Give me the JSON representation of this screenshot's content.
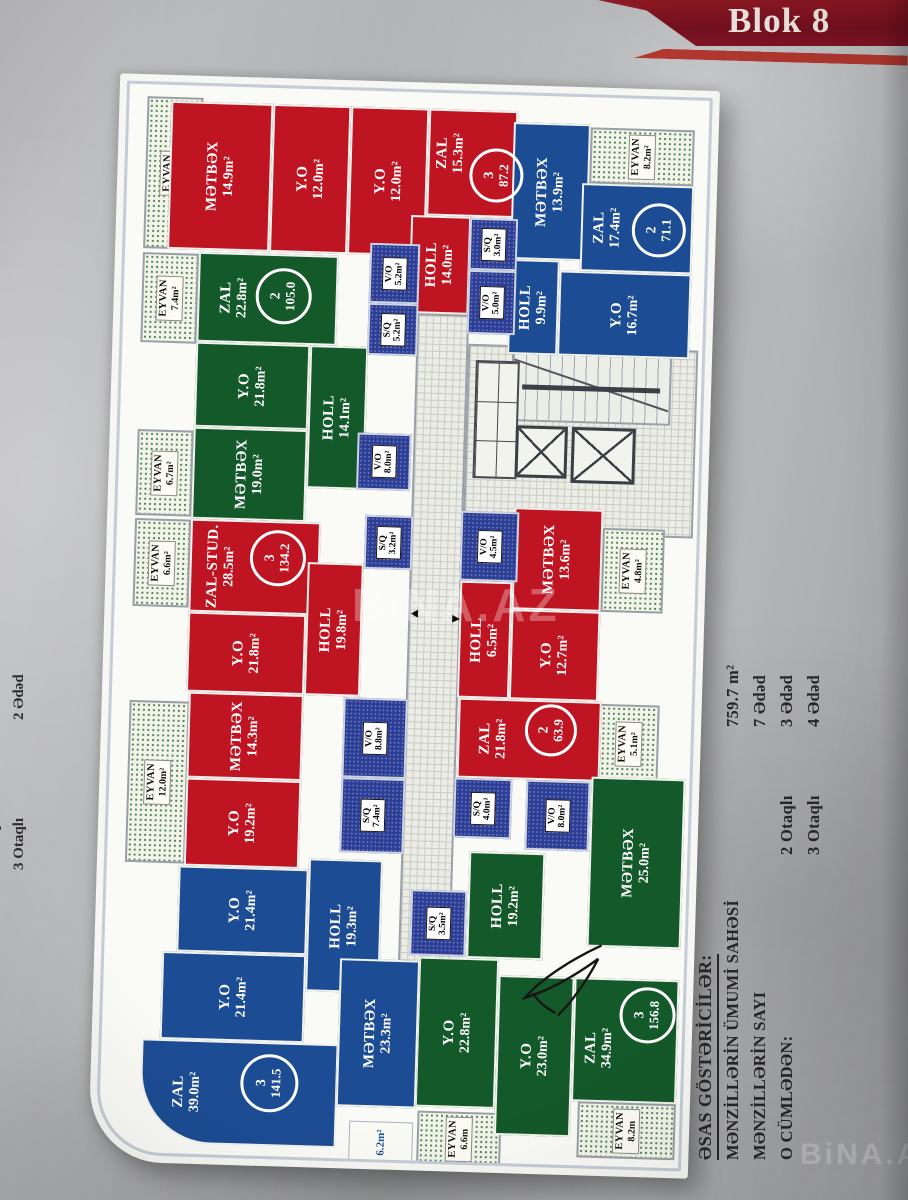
{
  "banner": {
    "title": "Blok 8"
  },
  "watermark": "BiNA.AZ",
  "legend_right": {
    "title": "ƏSAS GÖSTƏRİCİLƏR:",
    "rows": [
      {
        "label": "MƏNZİLLƏRİN ÜMUMİ SAHƏSİ",
        "mid": "",
        "value": "759.7 m²"
      },
      {
        "label": "MƏNZİLLƏRİN SAYI",
        "mid": "",
        "value": "7 Ədəd"
      },
      {
        "label": "O CÜMLƏDƏN:",
        "mid": "2 Otaqlı",
        "value": "3 Ədəd"
      },
      {
        "label": "",
        "mid": "3 Otaqlı",
        "value": "4 Ədəd"
      }
    ]
  },
  "legend_left": {
    "rows": [
      {
        "label": "2 Otaqlı",
        "value": "2 Ədəd"
      },
      {
        "label": "3 Otaqlı",
        "value": "2 Ədəd"
      }
    ]
  },
  "plan": {
    "rooms": [
      {
        "n": "EYVAN",
        "a": "10.8m²",
        "t": "eyvan",
        "x": 18,
        "y": 12,
        "w": 56,
        "h": 152
      },
      {
        "n": "EYVAN",
        "a": "7.4m²",
        "t": "eyvan",
        "x": 18,
        "y": 168,
        "w": 56,
        "h": 90
      },
      {
        "n": "EYVAN",
        "a": "6.7m²",
        "t": "eyvan",
        "x": 18,
        "y": 345,
        "w": 56,
        "h": 86
      },
      {
        "n": "EYVAN",
        "a": "6.6m²",
        "t": "eyvan",
        "x": 18,
        "y": 434,
        "w": 56,
        "h": 88
      },
      {
        "n": "EYVAN",
        "a": "12.0m²",
        "t": "eyvan",
        "x": 18,
        "y": 616,
        "w": 60,
        "h": 162
      },
      {
        "n": "EYVAN",
        "a": "8.2m²",
        "t": "eyvan",
        "x": 462,
        "y": 30,
        "w": 104,
        "h": 56
      },
      {
        "n": "EYVAN",
        "a": "4.8m²",
        "t": "eyvan",
        "x": 486,
        "y": 430,
        "w": 62,
        "h": 84
      },
      {
        "n": "EYVAN",
        "a": "5.1m²",
        "t": "eyvan",
        "x": 488,
        "y": 606,
        "w": 60,
        "h": 78
      },
      {
        "n": "EYVAN",
        "a": "6.6m",
        "t": "eyvan",
        "x": 318,
        "y": 1018,
        "w": 84,
        "h": 54
      },
      {
        "n": "EYVAN",
        "a": "8.2m",
        "t": "eyvan",
        "x": 478,
        "y": 1004,
        "w": 98,
        "h": 56
      },
      {
        "n": "",
        "a": "6.2m²",
        "t": "strip",
        "x": 250,
        "y": 1030,
        "w": 64,
        "h": 42
      },
      {
        "n": "MƏTBƏX",
        "a": "14.9m²",
        "t": "red",
        "x": 42,
        "y": 16,
        "w": 102,
        "h": 148
      },
      {
        "n": "Y.O",
        "a": "12.0m²",
        "t": "red",
        "x": 144,
        "y": 16,
        "w": 78,
        "h": 148
      },
      {
        "n": "Y.O",
        "a": "12.0m²",
        "t": "red",
        "x": 222,
        "y": 16,
        "w": 78,
        "h": 148
      },
      {
        "n": "ZAL",
        "a": "15.3m²",
        "t": "red",
        "x": 300,
        "y": 16,
        "w": 89,
        "h": 107,
        "dx": -22,
        "dy": -10
      },
      {
        "n": "HOLL",
        "a": "14.0m²",
        "t": "red",
        "x": 285,
        "y": 123,
        "w": 60,
        "h": 98
      },
      {
        "n": "MƏTBƏX",
        "a": "13.9m²",
        "t": "blue",
        "x": 385,
        "y": 27,
        "w": 77,
        "h": 137
      },
      {
        "n": "ZAL",
        "a": "17.4m²",
        "t": "blue",
        "x": 455,
        "y": 86,
        "w": 112,
        "h": 88,
        "dx": -30
      },
      {
        "n": "Y.O",
        "a": "16.7m²",
        "t": "blue",
        "x": 435,
        "y": 174,
        "w": 132,
        "h": 85
      },
      {
        "n": "HOLL",
        "a": "9.9m²",
        "t": "blue",
        "x": 385,
        "y": 164,
        "w": 50,
        "h": 95
      },
      {
        "n": "ZAL",
        "a": "22.8m²",
        "t": "green",
        "x": 74,
        "y": 166,
        "w": 140,
        "h": 90,
        "dx": -34
      },
      {
        "n": "Y.O",
        "a": "21.8m²",
        "t": "green",
        "x": 74,
        "y": 256,
        "w": 114,
        "h": 85
      },
      {
        "n": "MƏTBƏX",
        "a": "19.0m²",
        "t": "green",
        "x": 74,
        "y": 341,
        "w": 114,
        "h": 92
      },
      {
        "n": "HOLL",
        "a": "14.1m²",
        "t": "green",
        "x": 188,
        "y": 256,
        "w": 58,
        "h": 143
      },
      {
        "n": "ZAL-STUD.",
        "a": "28.5m²",
        "t": "red",
        "x": 74,
        "y": 433,
        "w": 130,
        "h": 93,
        "dx": -34
      },
      {
        "n": "Y.O",
        "a": "21.8m²",
        "t": "red",
        "x": 74,
        "y": 526,
        "w": 118,
        "h": 80
      },
      {
        "n": "MƏTBƏX",
        "a": "14.3m²",
        "t": "red",
        "x": 77,
        "y": 606,
        "w": 115,
        "h": 86
      },
      {
        "n": "Y.O",
        "a": "19.2m²",
        "t": "red",
        "x": 77,
        "y": 692,
        "w": 115,
        "h": 88
      },
      {
        "n": "HOLL",
        "a": "19.8m²",
        "t": "red",
        "x": 192,
        "y": 473,
        "w": 56,
        "h": 133
      },
      {
        "n": "MƏTBƏX",
        "a": "13.6m²",
        "t": "red",
        "x": 397,
        "y": 412,
        "w": 89,
        "h": 102
      },
      {
        "n": "HOLL",
        "a": "6.5m²",
        "t": "red",
        "x": 345,
        "y": 487,
        "w": 52,
        "h": 117
      },
      {
        "n": "Y.O",
        "a": "12.7m²",
        "t": "red",
        "x": 397,
        "y": 514,
        "w": 89,
        "h": 90
      },
      {
        "n": "ZAL",
        "a": "21.8m²",
        "t": "red",
        "x": 347,
        "y": 604,
        "w": 143,
        "h": 80,
        "dx": -36
      },
      {
        "n": "MƏTBƏX",
        "a": "25.0m²",
        "t": "green",
        "x": 482,
        "y": 679,
        "w": 94,
        "h": 170
      },
      {
        "n": "HOLL",
        "a": "19.2m²",
        "t": "green",
        "x": 362,
        "y": 757,
        "w": 76,
        "h": 107
      },
      {
        "n": "Y.O",
        "a": "22.8m²",
        "t": "green",
        "x": 315,
        "y": 864,
        "w": 80,
        "h": 150
      },
      {
        "n": "Y.O",
        "a": "23.0m²",
        "t": "green",
        "x": 395,
        "y": 880,
        "w": 76,
        "h": 160
      },
      {
        "n": "ZAL",
        "a": "34.9m²",
        "t": "green",
        "x": 471,
        "y": 880,
        "w": 105,
        "h": 124,
        "dx": -26,
        "dy": 8
      },
      {
        "n": "HOLL",
        "a": "19.3m²",
        "t": "blue",
        "x": 202,
        "y": 769,
        "w": 74,
        "h": 133
      },
      {
        "n": "Y.O",
        "a": "21.4m²",
        "t": "blue",
        "x": 72,
        "y": 780,
        "w": 130,
        "h": 86
      },
      {
        "n": "Y.O",
        "a": "21.4m²",
        "t": "blue",
        "x": 58,
        "y": 866,
        "w": 144,
        "h": 88
      },
      {
        "n": "ZAL",
        "a": "39.0m²",
        "t": "blue",
        "x": 40,
        "y": 954,
        "w": 197,
        "h": 104,
        "round": true,
        "dx": -52
      },
      {
        "n": "MƏTBƏX",
        "a": "23.3m²",
        "t": "blue",
        "x": 236,
        "y": 868,
        "w": 80,
        "h": 148
      },
      {
        "n": "S/Q",
        "a": "3.0m²",
        "t": "wet",
        "x": 344,
        "y": 124,
        "w": 48,
        "h": 52
      },
      {
        "n": "V/O",
        "a": "5.0m²",
        "t": "wet",
        "x": 344,
        "y": 176,
        "w": 48,
        "h": 64
      },
      {
        "n": "V/O",
        "a": "5.2m²",
        "t": "wet",
        "x": 245,
        "y": 152,
        "w": 50,
        "h": 60
      },
      {
        "n": "S/Q",
        "a": "5.2m²",
        "t": "wet",
        "x": 245,
        "y": 212,
        "w": 50,
        "h": 52
      },
      {
        "n": "V/O",
        "a": "8.0m²",
        "t": "wet",
        "x": 238,
        "y": 342,
        "w": 54,
        "h": 57
      },
      {
        "n": "S/Q",
        "a": "3.2m²",
        "t": "wet",
        "x": 248,
        "y": 424,
        "w": 48,
        "h": 54
      },
      {
        "n": "V/O",
        "a": "4.5m²",
        "t": "wet",
        "x": 344,
        "y": 417,
        "w": 58,
        "h": 70
      },
      {
        "n": "V/O",
        "a": "8.8m²",
        "t": "wet",
        "x": 232,
        "y": 607,
        "w": 64,
        "h": 80
      },
      {
        "n": "S/Q",
        "a": "7.4m²",
        "t": "wet",
        "x": 232,
        "y": 687,
        "w": 64,
        "h": 75
      },
      {
        "n": "S/Q",
        "a": "4.0m²",
        "t": "wet",
        "x": 345,
        "y": 684,
        "w": 58,
        "h": 60
      },
      {
        "n": "V/O",
        "a": "8.0m²",
        "t": "wet",
        "x": 417,
        "y": 684,
        "w": 64,
        "h": 70
      },
      {
        "n": "S/Q",
        "a": "3.5m²",
        "t": "wet",
        "x": 305,
        "y": 797,
        "w": 56,
        "h": 66
      }
    ],
    "badges": [
      {
        "num": "3",
        "total": "87.2",
        "x": 342,
        "y": 54,
        "d": 48
      },
      {
        "num": "2",
        "total": "71.1",
        "x": 506,
        "y": 104,
        "d": 48
      },
      {
        "num": "2",
        "total": "105.0",
        "x": 132,
        "y": 180,
        "d": 50
      },
      {
        "num": "3",
        "total": "134.2",
        "x": 134,
        "y": 442,
        "d": 50
      },
      {
        "num": "2",
        "total": "63.9",
        "x": 414,
        "y": 608,
        "d": 46
      },
      {
        "num": "3",
        "total": "156.8",
        "x": 517,
        "y": 888,
        "d": 50
      },
      {
        "num": "3",
        "total": "141.5",
        "x": 140,
        "y": 966,
        "d": 52
      }
    ]
  }
}
